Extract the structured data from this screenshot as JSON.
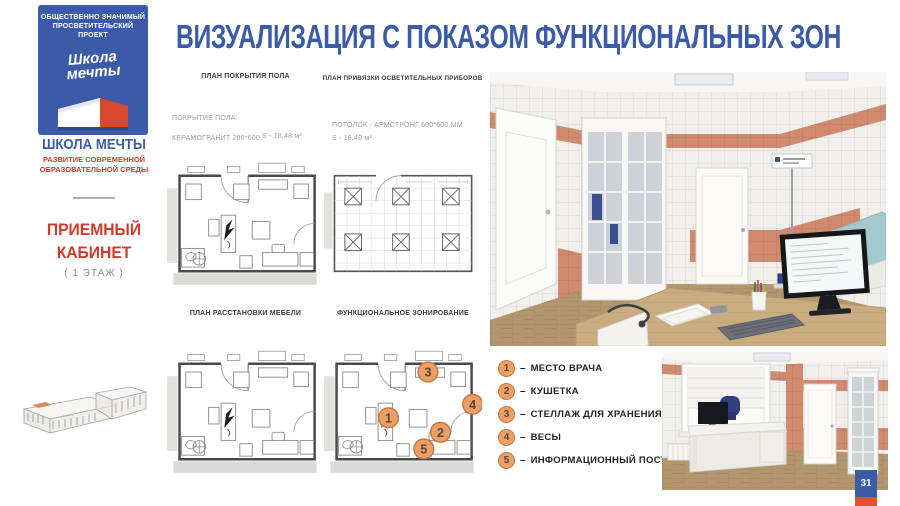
{
  "page": {
    "title": "ВИЗУАЛИЗАЦИЯ С ПОКАЗОМ ФУНКЦИОНАЛЬНЫХ ЗОН",
    "number": "31"
  },
  "brand": {
    "badge_line1": "ОБЩЕСТВЕННО ЗНАЧИМЫЙ",
    "badge_line2": "ПРОСВЕТИТЕЛЬСКИЙ ПРОЕКТ",
    "logo_script_line1": "Школа",
    "logo_script_line2": "мечты",
    "name": "ШКОЛА МЕЧТЫ",
    "tagline_line1": "РАЗВИТИЕ СОВРЕМЕННОЙ",
    "tagline_line2": "ОБРАЗОВАТЕЛЬНОЙ СРЕДЫ"
  },
  "room": {
    "title_line1": "ПРИЕМНЫЙ",
    "title_line2": "КАБИНЕТ",
    "floor_note": "( 1 ЭТАЖ )"
  },
  "plans": {
    "floor_covering_label": "ПЛАН ПОКРЫТИЯ ПОЛА",
    "lighting_label": "ПЛАН ПРИВЯЗКИ ОСВЕТИТЕЛЬНЫХ ПРИБОРОВ",
    "furniture_label": "ПЛАН РАССТАНОВКИ МЕБЕЛИ",
    "zoning_label": "ФУНКЦИОНАЛЬНОЕ ЗОНИРОВАНИЕ",
    "floor_spec_title": "ПОКРЫТИЕ ПОЛА:",
    "floor_spec_material": "КЕРАМОГРАНИТ 200*600,",
    "floor_spec_area": "S - 18,48 м²",
    "ceiling_spec": "ПОТОЛОК - АРМСТРОНГ 600*600 ММ",
    "ceiling_spec_area": "S - 18,48 м²"
  },
  "legend": {
    "dash": "–",
    "items": [
      {
        "num": "1",
        "label": "МЕСТО ВРАЧА"
      },
      {
        "num": "2",
        "label": "КУШЕТКА"
      },
      {
        "num": "3",
        "label": "СТЕЛЛАЖ ДЛЯ ХРАНЕНИЯ ПРЕПАРАТОВ"
      },
      {
        "num": "4",
        "label": "ВЕСЫ"
      },
      {
        "num": "5",
        "label": "ИНФОРМАЦИОННЫЙ ПОСТЕР"
      }
    ]
  },
  "colors": {
    "brand_blue": "#3b5ba9",
    "brand_red": "#d13a2a",
    "zone_marker_orange": "#ed9f66",
    "tile_salmon": "#cf8a70",
    "page_tab_orange": "#e2522e"
  }
}
